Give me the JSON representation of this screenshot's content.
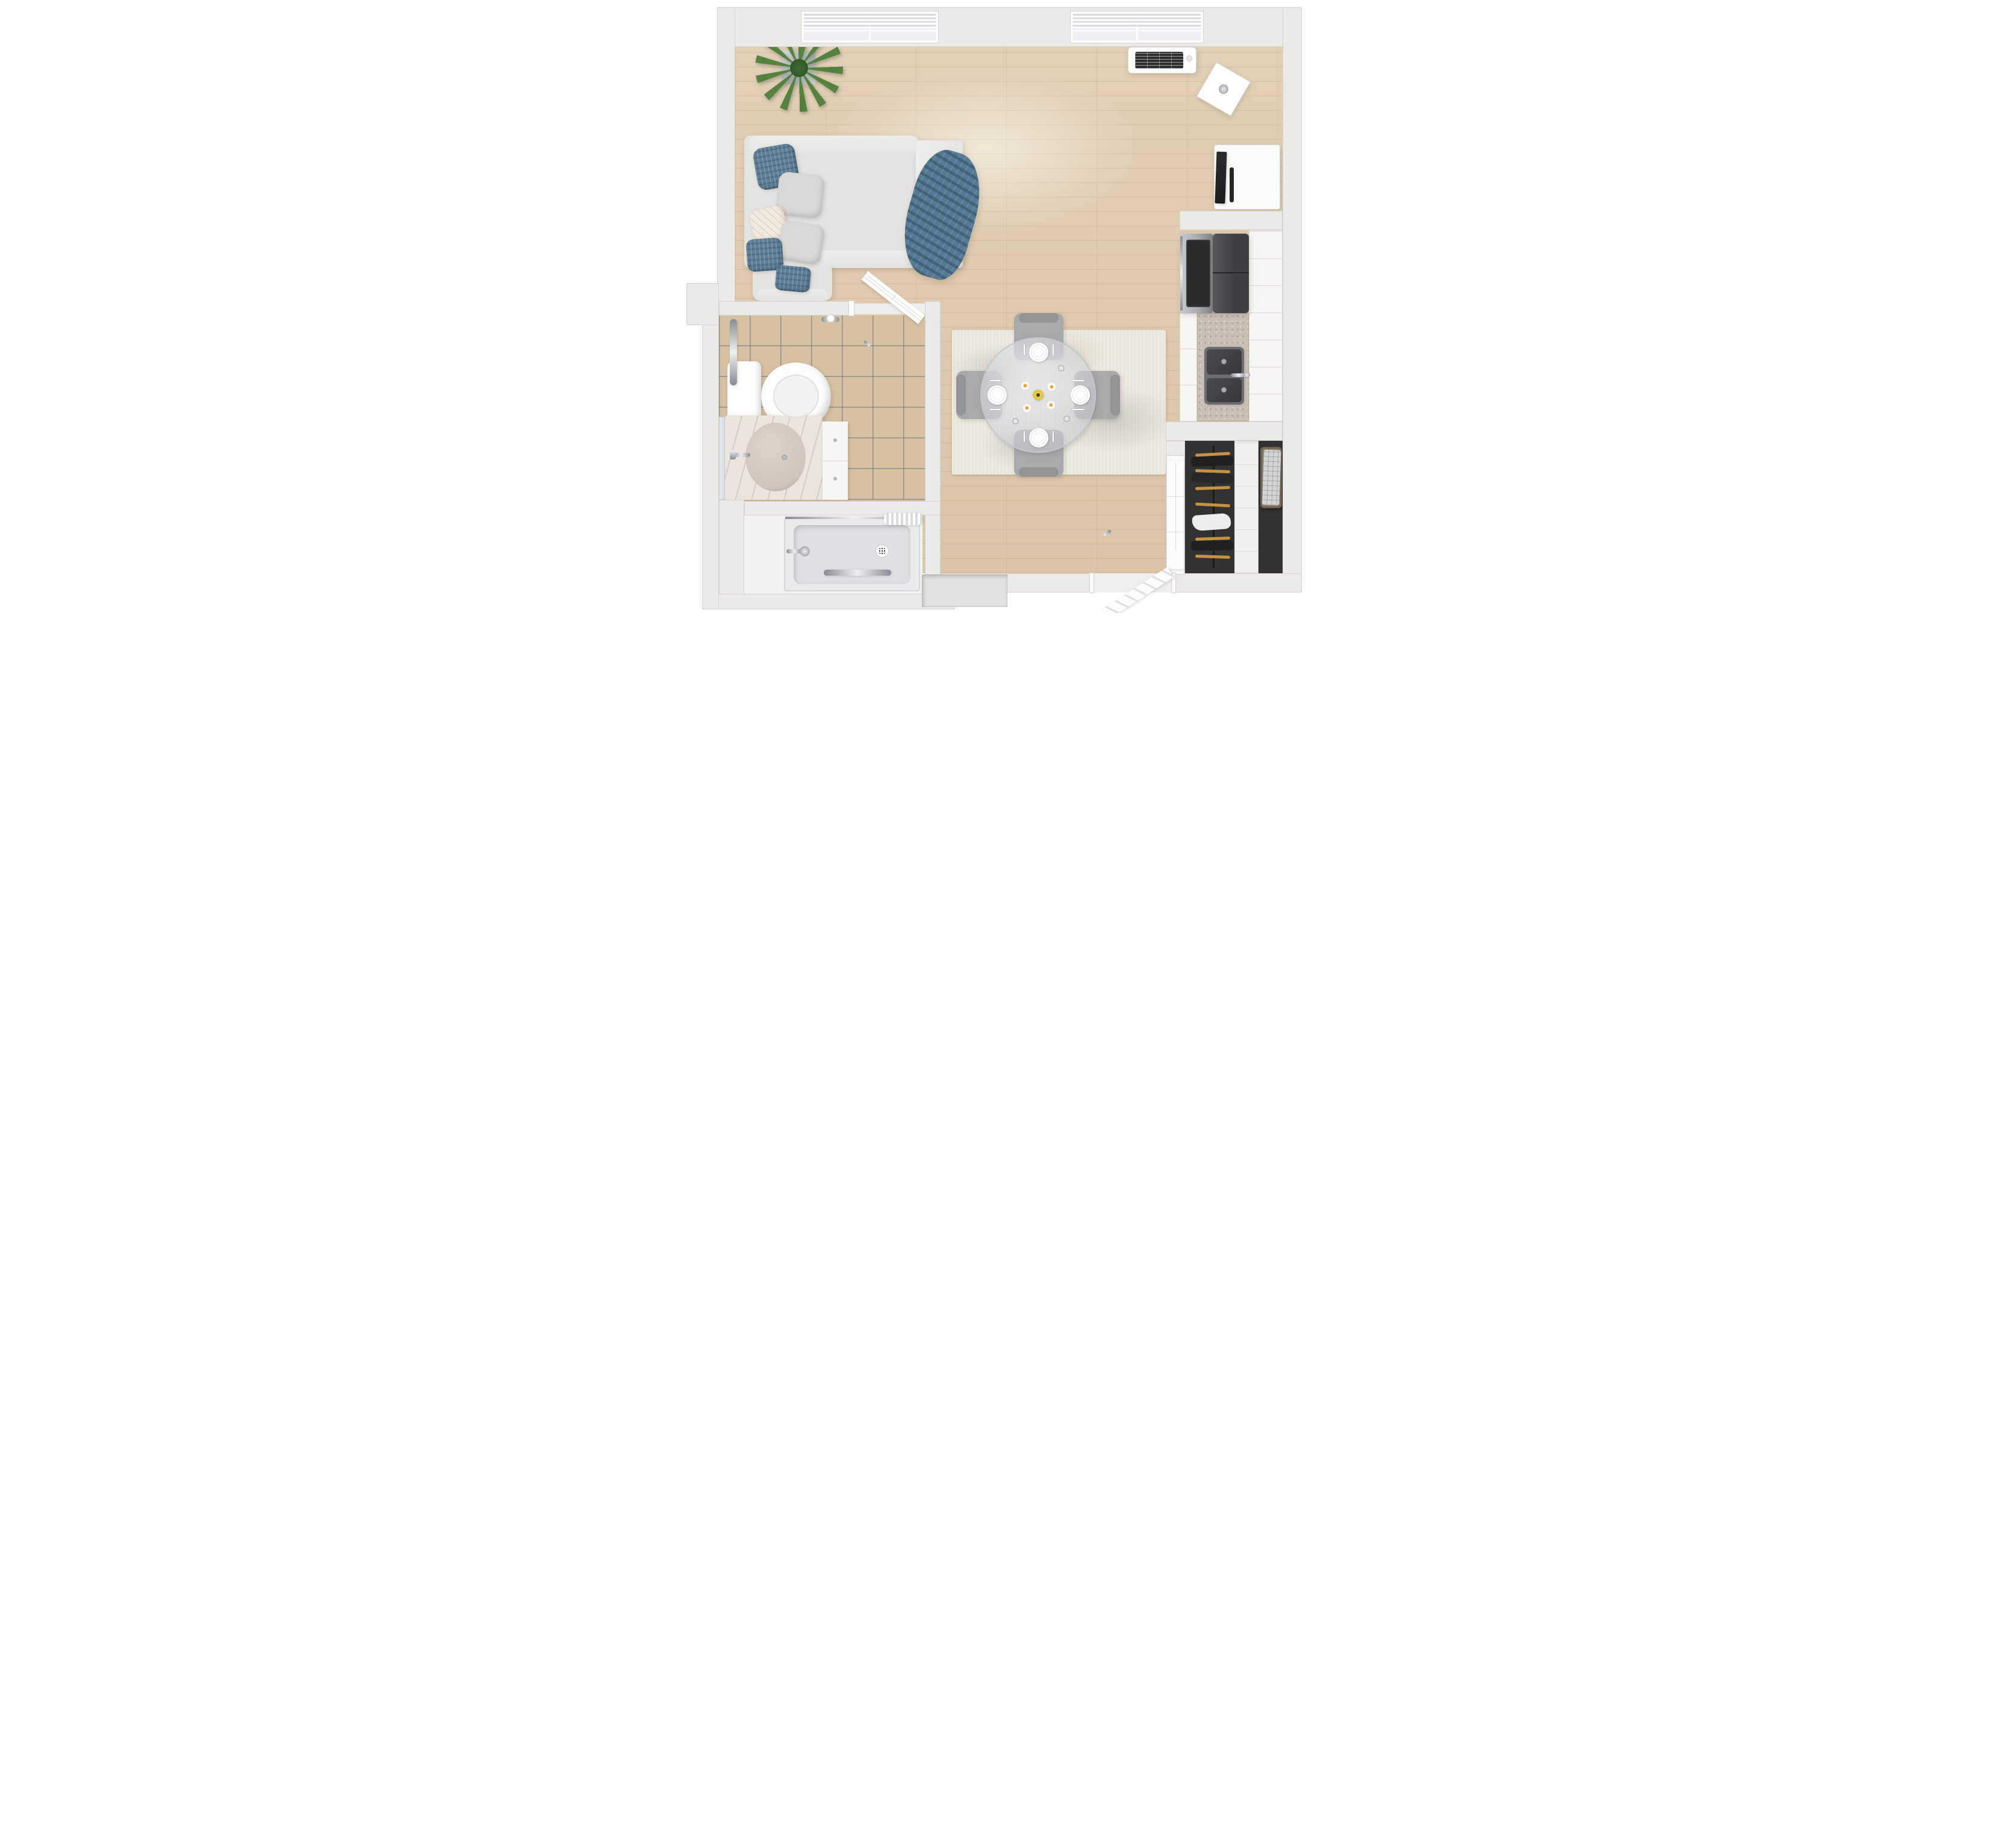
{
  "scene": {
    "type": "3d-floor-plan-top-down-render",
    "unit": "studio-apartment",
    "floors": [
      "hardwood-planks",
      "beige-ceramic-tile",
      "gray-shower-pan",
      "dark-closet"
    ],
    "rooms": [
      {
        "name": "living-area",
        "items": [
          "sleeper-sofa",
          "throw-pillows",
          "blue-throw-blanket",
          "armchair",
          "potted-plant",
          "mirror-cube-side-table",
          "floor-lamp",
          "tv-stand",
          "flat-screen-tv",
          "soundbar",
          "wall-ac-unit",
          "window-with-blinds",
          "window-with-blinds"
        ]
      },
      {
        "name": "dining-area",
        "items": [
          "distressed-area-rug",
          "round-glass-dining-table",
          "dining-chair-north",
          "dining-chair-south",
          "dining-chair-west",
          "dining-chair-east",
          "place-settings",
          "wine-glasses",
          "yellow-vase-with-daisies"
        ]
      },
      {
        "name": "kitchen",
        "items": [
          "stainless-range",
          "black-refrigerator",
          "white-base-cabinets",
          "white-upper-cabinets",
          "granite-countertop",
          "stainless-double-sink",
          "faucet"
        ]
      },
      {
        "name": "bathroom",
        "items": [
          "toilet",
          "vertical-grab-bar",
          "toilet-paper-holder",
          "marble-vanity",
          "vanity-sink",
          "vanity-faucet",
          "vanity-cabinet",
          "wall-mirror",
          "six-panel-door-open"
        ]
      },
      {
        "name": "shower-room",
        "items": [
          "roll-in-shower-pan",
          "floor-drain",
          "shower-head",
          "horizontal-grab-bar",
          "curtain-rod",
          "bunched-shower-curtain"
        ]
      },
      {
        "name": "closet",
        "items": [
          "closed-six-panel-door",
          "hanging-rod",
          "wood-hangers",
          "dark-clothes",
          "white-garment",
          "shelf-tower",
          "storage-basket-with-plaid-cloth"
        ]
      },
      {
        "name": "entry",
        "items": [
          "entry-door-open",
          "door-threshold",
          "wall-niche",
          "switch-plates"
        ]
      }
    ]
  },
  "palette": {
    "wall": "#ECEAE6",
    "wall_edge": "#D6D3CC",
    "wood": "#DECAAE",
    "plank_line": "rgba(150,112,74,0.16)",
    "plank_seam": "rgba(150,112,74,0.10)",
    "tile": "#D6C1A3",
    "grout": "rgba(96,98,118,0.55)",
    "floor_light": "#F2F2F1",
    "sofa": "#E4E3E0",
    "pillow_blue": "#5E7F98",
    "pillow_gray": "#DBD9D5",
    "pillow_cream": "#F1EADF",
    "blanket": "#567A93",
    "chair": "#A9A9AC",
    "chair_dark": "#939396",
    "rug": "#EAE6DC",
    "rug_spot": "rgba(125,130,125,0.28)",
    "glass": "rgba(198,205,210,0.5)",
    "glass_edge": "#C2C8CC",
    "vase": "#D2B838",
    "plant": "#55833F",
    "plant_dark": "#3E6B31",
    "steel_light": "#C9CCCF",
    "steel": "#A7ABAE",
    "steel_dark": "#7E8285",
    "black": "#2A2B2D",
    "appliance": "#3F4043",
    "cabinet": "#F7F6F3",
    "cabinet_line": "#DCD9D3",
    "granite": "#C9C0B2",
    "sink": "#35373B",
    "sink_rim": "#6A6D72",
    "chrome_hi": "#EDF0F2",
    "chrome": "#AEB4BA",
    "chrome_dark": "#868C92",
    "marble": "#EBE5DE",
    "marble_vein": "rgba(160,150,135,0.30)",
    "basin": "#CFC5BA",
    "porcelain": "#FDFDFC",
    "mirror": "#E7EDEF",
    "closet_dark": "#323234",
    "hanger": "#C8913F",
    "cloth_dark": "#202022",
    "cloth_white": "#EDEDEB",
    "shelf": "#F1F0EE",
    "basket": "#8A7A66",
    "basket_dark": "#6F6152",
    "plaid": "#D4D4D2",
    "door": "#FCFCFB",
    "door_line": "#DEDBD6",
    "niche": "#E3E2E0",
    "pan": "#E9EAEC",
    "pan_inner": "#DEE1E4",
    "ac_grill": "#2C2D2F",
    "tv": "#1C1D1F",
    "shadow": "rgba(70,60,45,0.18)"
  }
}
